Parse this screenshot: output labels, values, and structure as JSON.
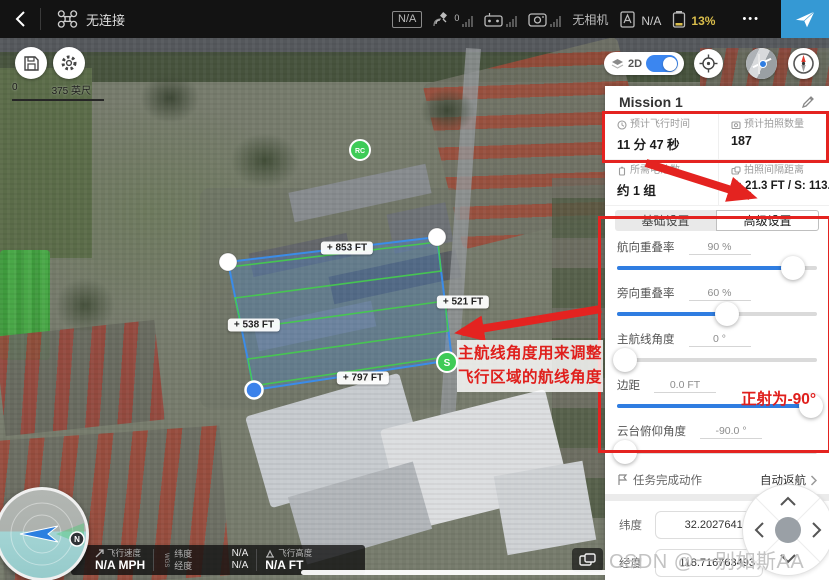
{
  "top_bar": {
    "device_status": "无连接",
    "signal_badge": "N/A",
    "gps_count": "0",
    "camera_status": "无相机",
    "flight_mode_value": "N/A",
    "battery_percent": "13%",
    "more_label": "•••"
  },
  "map_controls": {
    "scale_start": "0",
    "scale_end": "375 英尺",
    "view_mode": "2D"
  },
  "mission_area": {
    "edge_top": "+ 853 FT",
    "edge_right": "+ 521 FT",
    "edge_left": "+ 538 FT",
    "edge_bottom": "+ 797 FT",
    "rc_marker": "RC",
    "start_marker": "S",
    "north_label": "N"
  },
  "annotations": {
    "advanced_note_line1": "主航线角度用来调整",
    "advanced_note_line2": "飞行区域的航线角度",
    "gimbal_note": "正射为-90°"
  },
  "panel": {
    "title": "Mission 1",
    "stats": [
      {
        "label": "预计飞行时间",
        "value": "11 分 47 秒"
      },
      {
        "label": "预计拍照数量",
        "value": "187"
      },
      {
        "label": "所需电池数",
        "value": "约 1 组"
      },
      {
        "label": "拍照间隔距离",
        "value": "F: 21.3 FT / S: 113.6 FT"
      }
    ],
    "tabs": [
      {
        "label": "基础设置"
      },
      {
        "label": "高级设置"
      }
    ],
    "sliders": [
      {
        "label": "航向重叠率",
        "value": "90 %",
        "percent": 88
      },
      {
        "label": "旁向重叠率",
        "value": "60 %",
        "percent": 55
      },
      {
        "label": "主航线角度",
        "value": "0 °",
        "percent": 4
      },
      {
        "label": "边距",
        "value": "0.0 FT",
        "percent": 97
      },
      {
        "label": "云台俯仰角度",
        "value": "-90.0 °",
        "percent": 4
      }
    ],
    "finish_action": {
      "label": "任务完成动作",
      "value": "自动返航"
    },
    "coordinates": [
      {
        "label": "纬度",
        "value": "32.202764195"
      },
      {
        "label": "经度",
        "value": "118.716763493"
      }
    ]
  },
  "telemetry": {
    "speed_label": "飞行速度",
    "speed_value": "N/A MPH",
    "datum": "WGS",
    "lat_label": "纬度",
    "lat_value": "N/A",
    "lng_label": "经度",
    "lng_value": "N/A",
    "alt_label": "飞行高度",
    "alt_value": "N/A FT"
  },
  "watermark": "CSDN @一别如斯AA",
  "colors": {
    "accent_blue": "#2f7de1",
    "takeoff_blue": "#3599d4",
    "battery_warning": "#d9bd4b",
    "annotation_red": "#e42320",
    "route_green": "#46c94f",
    "polygon_blue": "#3b8ce8"
  }
}
